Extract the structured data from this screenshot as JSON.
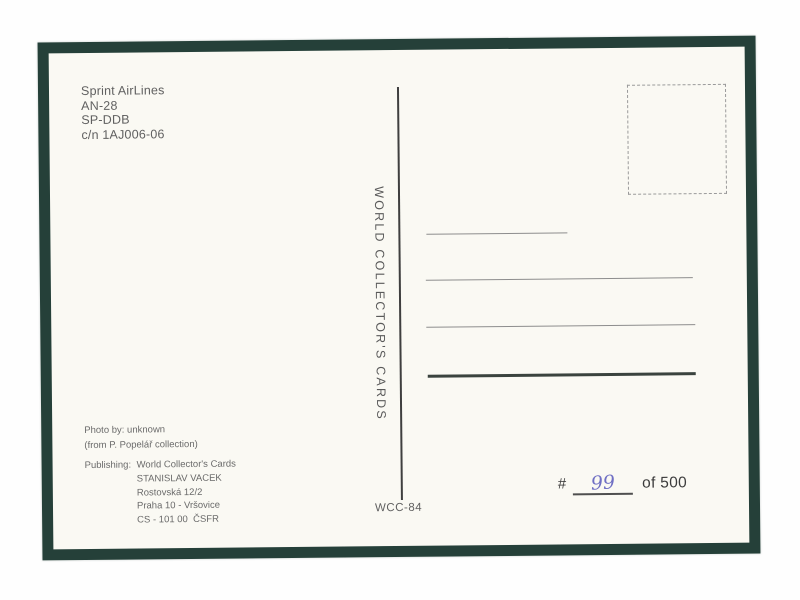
{
  "card": {
    "subject": [
      "Sprint AirLines",
      "AN-28",
      "SP-DDB",
      "c/n 1AJ006-06"
    ],
    "brand_vertical": "WORLD COLLECTOR'S CARDS",
    "photo_credit": [
      "Photo by: unknown",
      "(from P. Popelář collection)"
    ],
    "publishing": {
      "label": "Publishing:",
      "lines": [
        "World Collector's Cards",
        "STANISLAV VACEK",
        "Rostovská 12/2",
        "Praha 10 - Vršovice",
        "CS - 101 00  ČSFR"
      ]
    },
    "code": "WCC-84",
    "numbering": {
      "hash": "#",
      "number": "99",
      "of": "of 500"
    },
    "colors": {
      "border_green": "#254039",
      "card_background": "#faf9f3",
      "print_text": "#606060",
      "handwriting_ink": "#6f6fc4"
    }
  }
}
